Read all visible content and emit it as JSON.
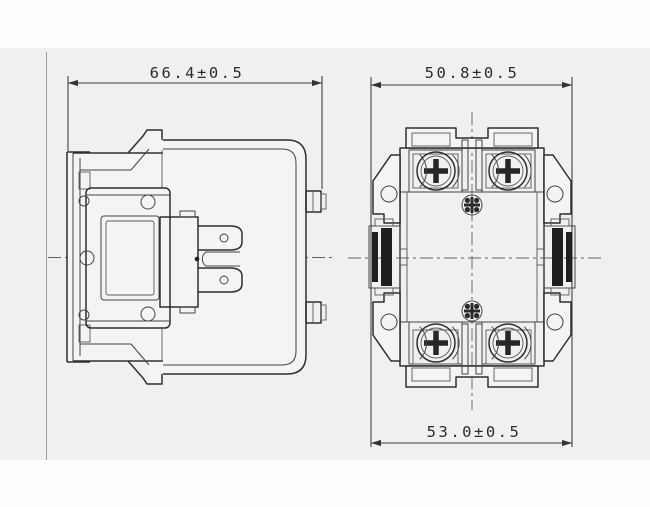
{
  "dimensions": {
    "side_view_width": "66.4±0.5",
    "front_view_width": "50.8±0.5",
    "front_view_mount_spacing": "53.0±0.5"
  }
}
